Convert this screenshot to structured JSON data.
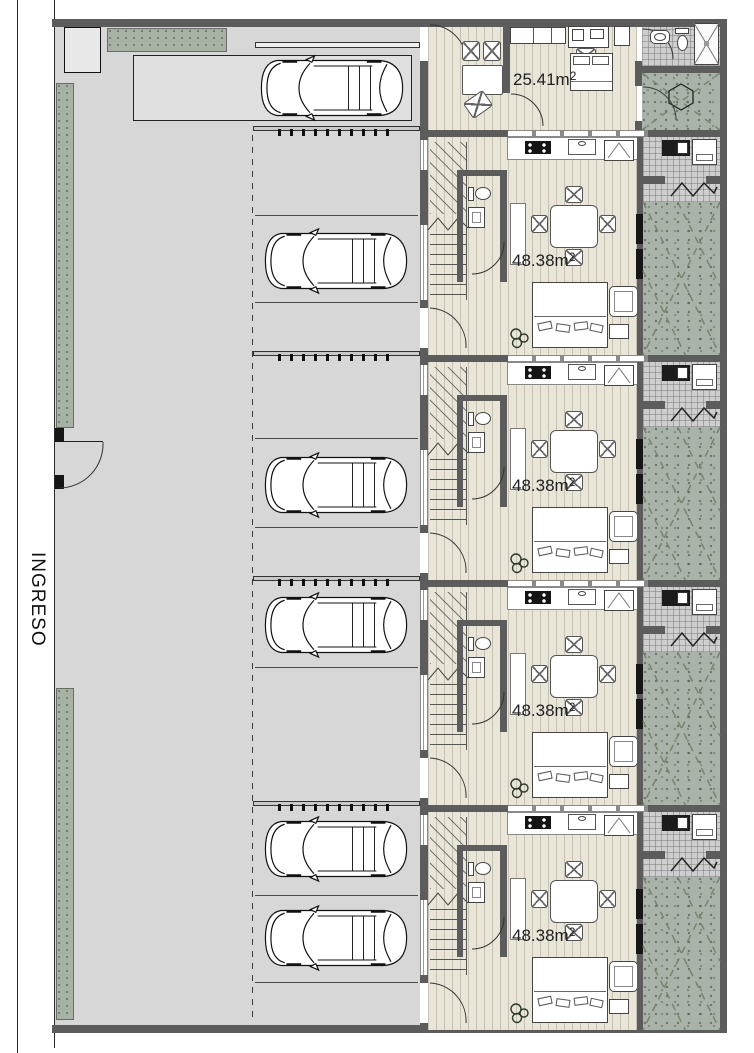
{
  "plan": {
    "entrance_label": "INGRESO",
    "studio": {
      "name": "unit-1-studio",
      "area": "25.41m",
      "sup": "2"
    },
    "duplex": {
      "name": "duplex-unit",
      "area": "48.38m",
      "sup": "2",
      "count": 4
    },
    "parking": {
      "car_count": 6,
      "bay_marking": "dashed"
    },
    "rooms": [
      "stairs",
      "wc",
      "kitchen",
      "dining",
      "bedroom-living",
      "laundry",
      "patio",
      "bathroom"
    ],
    "icons": [
      "car-icon",
      "toilet-icon",
      "sink-icon",
      "shower-icon",
      "washer-icon",
      "plant-icon",
      "hexagon-table-icon",
      "zigzag-icon"
    ],
    "colors": {
      "wall": "#5c5c5c",
      "parking": "#d7d7d7",
      "wood_floor": "#e9e5d8",
      "tile": "#cecece",
      "patio_green": "#a9b3a9",
      "strip_green": "#a7b2a4",
      "line": "#2a2a2a"
    }
  }
}
